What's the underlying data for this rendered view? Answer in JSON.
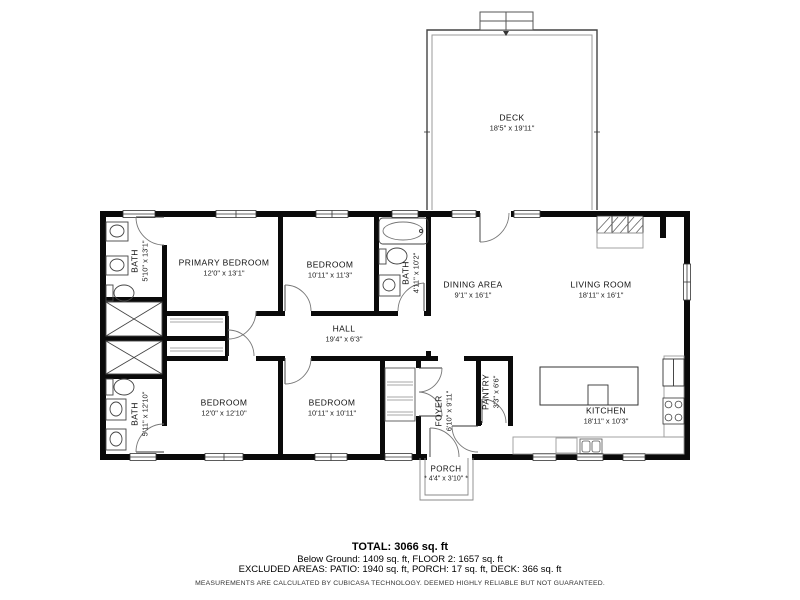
{
  "floorplan": {
    "rooms": [
      {
        "id": "deck",
        "name": "DECK",
        "dims": "18'5\" x 19'11\""
      },
      {
        "id": "bath-upper-left",
        "name": "BATH",
        "dims": "5'10\" x 13'1\""
      },
      {
        "id": "primary-bedroom",
        "name": "PRIMARY BEDROOM",
        "dims": "12'0\" x 13'1\""
      },
      {
        "id": "bedroom-top",
        "name": "BEDROOM",
        "dims": "10'11\" x 11'3\""
      },
      {
        "id": "bath-middle",
        "name": "BATH",
        "dims": "4'11\" x 10'2\""
      },
      {
        "id": "dining-area",
        "name": "DINING AREA",
        "dims": "9'1\" x 16'1\""
      },
      {
        "id": "living-room",
        "name": "LIVING ROOM",
        "dims": "18'11\" x 16'1\""
      },
      {
        "id": "hall",
        "name": "HALL",
        "dims": "19'4\" x 6'3\""
      },
      {
        "id": "bath-lower-left",
        "name": "BATH",
        "dims": "5'11\" x 12'10\""
      },
      {
        "id": "bedroom-bottom-left",
        "name": "BEDROOM",
        "dims": "12'0\" x 12'10\""
      },
      {
        "id": "bedroom-bottom-middle",
        "name": "BEDROOM",
        "dims": "10'11\" x 10'11\""
      },
      {
        "id": "foyer",
        "name": "FOYER",
        "dims": "6'10\" x 9'11\""
      },
      {
        "id": "pantry",
        "name": "PANTRY",
        "dims": "3'3\" x 6'6\""
      },
      {
        "id": "kitchen",
        "name": "KITCHEN",
        "dims": "18'11\" x 10'3\""
      },
      {
        "id": "porch",
        "name": "PORCH",
        "dims": "* 4'4\" x 3'10\" *"
      }
    ],
    "footer": {
      "total": "TOTAL: 3066 sq. ft",
      "floors": "Below Ground: 1409 sq. ft, FLOOR 2: 1657 sq. ft",
      "excluded": "EXCLUDED AREAS: PATIO: 1940 sq. ft, PORCH: 17 sq. ft, DECK: 366 sq. ft",
      "disclaimer": "MEASUREMENTS ARE CALCULATED BY CUBICASA TECHNOLOGY. DEEMED HIGHLY RELIABLE BUT NOT GUARANTEED."
    },
    "colors": {
      "wall": "#0a0a0a",
      "thin_line": "#555555",
      "counter_line": "#9a9a9a",
      "text": "#111111"
    }
  }
}
